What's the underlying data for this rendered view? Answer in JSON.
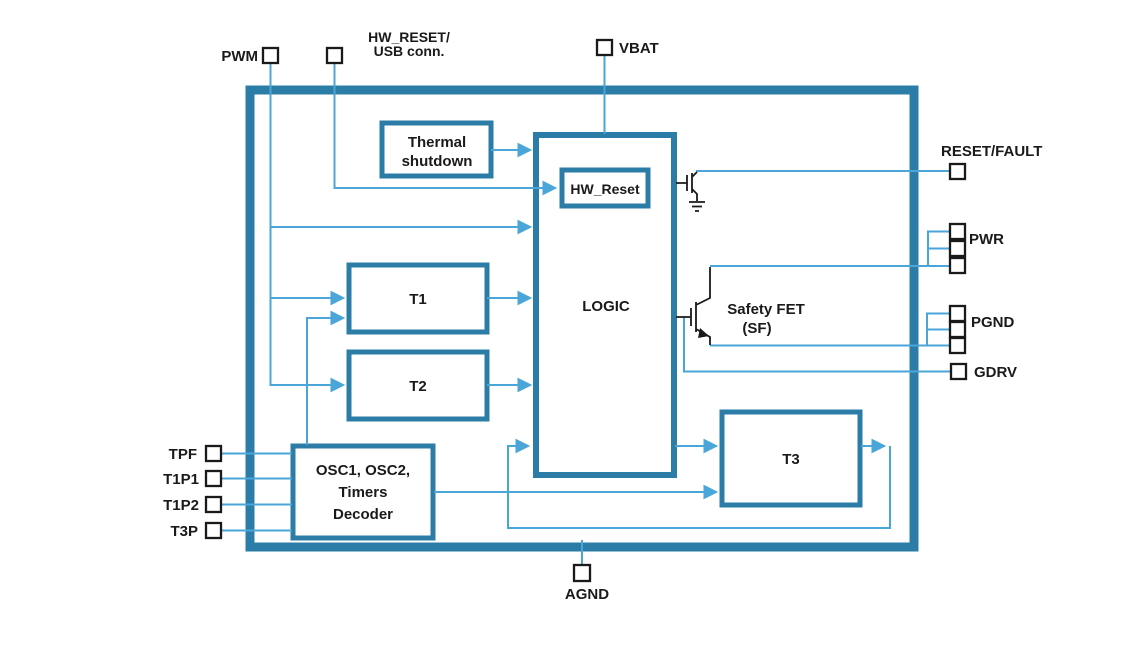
{
  "diagram": {
    "type": "ic-functional-block-diagram",
    "colors": {
      "block_border": "#2b7ca7",
      "wire": "#4aa6d8",
      "pin_outline": "#1a1a1a",
      "label_text": "#1a1a1a",
      "background": "#ffffff"
    },
    "blocks": {
      "thermal_shutdown": {
        "label_line1": "Thermal",
        "label_line2": "shutdown"
      },
      "logic": {
        "label": "LOGIC"
      },
      "hw_reset": {
        "label": "HW_Reset"
      },
      "t1": {
        "label": "T1"
      },
      "t2": {
        "label": "T2"
      },
      "t3": {
        "label": "T3"
      },
      "osc": {
        "label_line1": "OSC1, OSC2,",
        "label_line2": "Timers",
        "label_line3": "Decoder"
      },
      "safety_fet": {
        "label_line1": "Safety FET",
        "label_line2": "(SF)"
      }
    },
    "pins": {
      "pwm": {
        "label": "PWM"
      },
      "hw_reset_usb": {
        "label_line1": "HW_RESET/",
        "label_line2": "USB conn."
      },
      "vbat": {
        "label": "VBAT"
      },
      "reset_fault": {
        "label": "RESET/FAULT"
      },
      "pwr": {
        "label": "PWR"
      },
      "pgnd": {
        "label": "PGND"
      },
      "gdrv": {
        "label": "GDRV"
      },
      "tpf": {
        "label": "TPF"
      },
      "t1p1": {
        "label": "T1P1"
      },
      "t1p2": {
        "label": "T1P2"
      },
      "t3p": {
        "label": "T3P"
      },
      "agnd": {
        "label": "AGND"
      }
    }
  }
}
